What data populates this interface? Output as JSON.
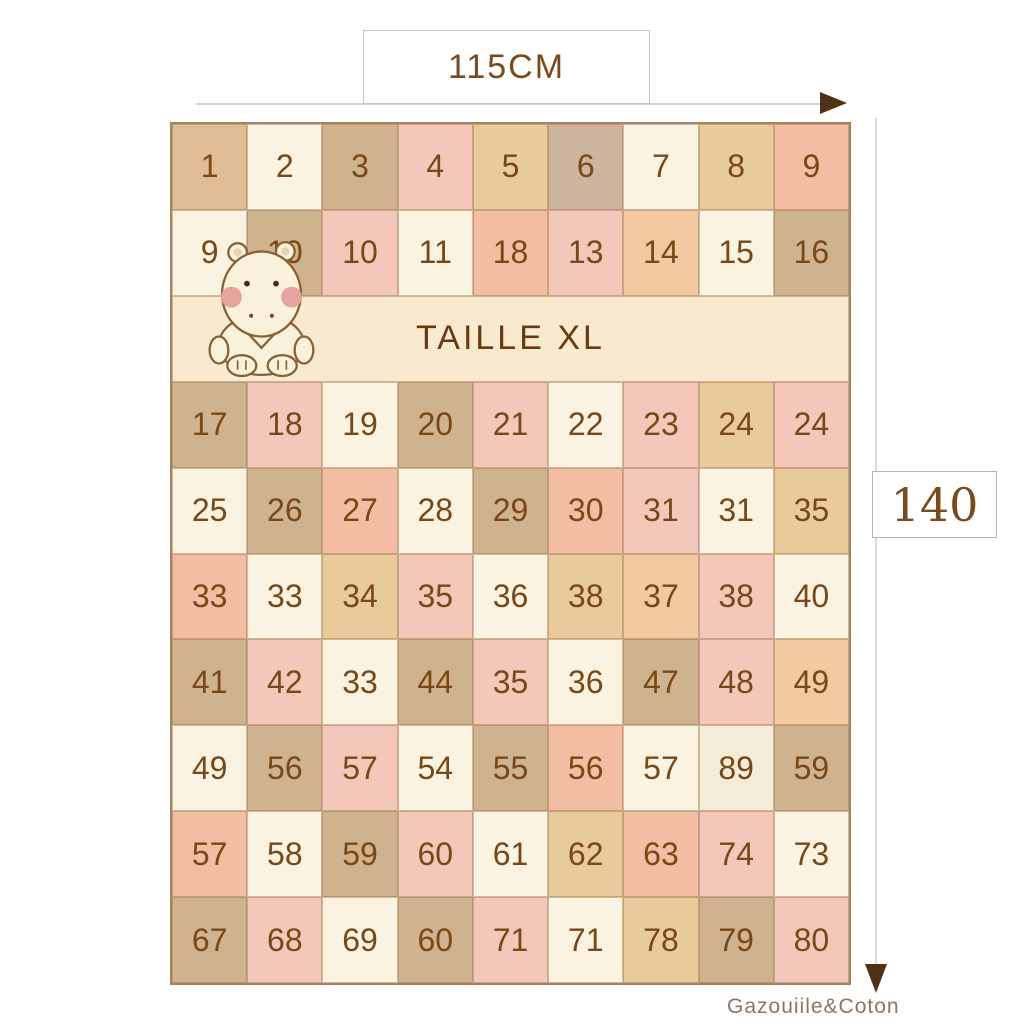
{
  "dimensions": {
    "width_label": "115CM",
    "height_label": "140"
  },
  "banner": {
    "label": "TAILLE XL"
  },
  "brand": {
    "label": "Gazouiile&Coton"
  },
  "icons": {
    "hippo": "hippo-mascot-icon",
    "arrow_right": "arrow-right-icon",
    "arrow_down": "arrow-down-icon"
  },
  "colors": {
    "number_text": "#7a4716",
    "banner_text": "#693910",
    "dimension_text": "#7b4a1c",
    "arrow": "#4f3115",
    "grid_border": "#a5835f",
    "banner_bg": "#f9e9ce"
  },
  "palette": {
    "cream": "#faf3e1",
    "cream2": "#f5ecd7",
    "tan": "#dfbc93",
    "dtan": "#cfb28e",
    "gtan": "#cdb49d",
    "wheat": "#e9cb9b",
    "pink": "#f3c8ba",
    "salmon": "#f2bda2",
    "peach": "#f3c9a2"
  },
  "grid": {
    "columns": 9,
    "rows": [
      {
        "type": "cells",
        "cells": [
          {
            "n": "1",
            "c": "tan"
          },
          {
            "n": "2",
            "c": "cream"
          },
          {
            "n": "3",
            "c": "dtan"
          },
          {
            "n": "4",
            "c": "pink"
          },
          {
            "n": "5",
            "c": "wheat"
          },
          {
            "n": "6",
            "c": "gtan"
          },
          {
            "n": "7",
            "c": "cream"
          },
          {
            "n": "8",
            "c": "wheat"
          },
          {
            "n": "9",
            "c": "salmon"
          }
        ]
      },
      {
        "type": "cells",
        "cells": [
          {
            "n": "9",
            "c": "cream"
          },
          {
            "n": "10",
            "c": "dtan"
          },
          {
            "n": "10",
            "c": "pink"
          },
          {
            "n": "11",
            "c": "cream"
          },
          {
            "n": "18",
            "c": "salmon"
          },
          {
            "n": "13",
            "c": "pink"
          },
          {
            "n": "14",
            "c": "peach"
          },
          {
            "n": "15",
            "c": "cream"
          },
          {
            "n": "16",
            "c": "dtan"
          }
        ]
      },
      {
        "type": "banner"
      },
      {
        "type": "cells",
        "cells": [
          {
            "n": "17",
            "c": "dtan"
          },
          {
            "n": "18",
            "c": "pink"
          },
          {
            "n": "19",
            "c": "cream"
          },
          {
            "n": "20",
            "c": "dtan"
          },
          {
            "n": "21",
            "c": "pink"
          },
          {
            "n": "22",
            "c": "cream"
          },
          {
            "n": "23",
            "c": "pink"
          },
          {
            "n": "24",
            "c": "wheat"
          },
          {
            "n": "24",
            "c": "pink"
          }
        ]
      },
      {
        "type": "cells",
        "cells": [
          {
            "n": "25",
            "c": "cream"
          },
          {
            "n": "26",
            "c": "dtan"
          },
          {
            "n": "27",
            "c": "salmon"
          },
          {
            "n": "28",
            "c": "cream"
          },
          {
            "n": "29",
            "c": "dtan"
          },
          {
            "n": "30",
            "c": "salmon"
          },
          {
            "n": "31",
            "c": "pink"
          },
          {
            "n": "31",
            "c": "cream"
          },
          {
            "n": "35",
            "c": "wheat"
          }
        ]
      },
      {
        "type": "cells",
        "cells": [
          {
            "n": "33",
            "c": "salmon"
          },
          {
            "n": "33",
            "c": "cream"
          },
          {
            "n": "34",
            "c": "wheat"
          },
          {
            "n": "35",
            "c": "pink"
          },
          {
            "n": "36",
            "c": "cream"
          },
          {
            "n": "38",
            "c": "wheat"
          },
          {
            "n": "37",
            "c": "peach"
          },
          {
            "n": "38",
            "c": "pink"
          },
          {
            "n": "40",
            "c": "cream"
          }
        ]
      },
      {
        "type": "cells",
        "cells": [
          {
            "n": "41",
            "c": "dtan"
          },
          {
            "n": "42",
            "c": "pink"
          },
          {
            "n": "33",
            "c": "cream"
          },
          {
            "n": "44",
            "c": "dtan"
          },
          {
            "n": "35",
            "c": "pink"
          },
          {
            "n": "36",
            "c": "cream"
          },
          {
            "n": "47",
            "c": "dtan"
          },
          {
            "n": "48",
            "c": "pink"
          },
          {
            "n": "49",
            "c": "peach"
          }
        ]
      },
      {
        "type": "cells",
        "cells": [
          {
            "n": "49",
            "c": "cream"
          },
          {
            "n": "56",
            "c": "dtan"
          },
          {
            "n": "57",
            "c": "pink"
          },
          {
            "n": "54",
            "c": "cream"
          },
          {
            "n": "55",
            "c": "dtan"
          },
          {
            "n": "56",
            "c": "salmon"
          },
          {
            "n": "57",
            "c": "cream"
          },
          {
            "n": "89",
            "c": "cream2"
          },
          {
            "n": "59",
            "c": "dtan"
          }
        ]
      },
      {
        "type": "cells",
        "cells": [
          {
            "n": "57",
            "c": "salmon"
          },
          {
            "n": "58",
            "c": "cream"
          },
          {
            "n": "59",
            "c": "dtan"
          },
          {
            "n": "60",
            "c": "pink"
          },
          {
            "n": "61",
            "c": "cream"
          },
          {
            "n": "62",
            "c": "wheat"
          },
          {
            "n": "63",
            "c": "salmon"
          },
          {
            "n": "74",
            "c": "pink"
          },
          {
            "n": "73",
            "c": "cream"
          }
        ]
      },
      {
        "type": "cells",
        "cells": [
          {
            "n": "67",
            "c": "dtan"
          },
          {
            "n": "68",
            "c": "pink"
          },
          {
            "n": "69",
            "c": "cream"
          },
          {
            "n": "60",
            "c": "dtan"
          },
          {
            "n": "71",
            "c": "pink"
          },
          {
            "n": "71",
            "c": "cream"
          },
          {
            "n": "78",
            "c": "wheat"
          },
          {
            "n": "79",
            "c": "dtan"
          },
          {
            "n": "80",
            "c": "pink"
          }
        ]
      }
    ]
  }
}
